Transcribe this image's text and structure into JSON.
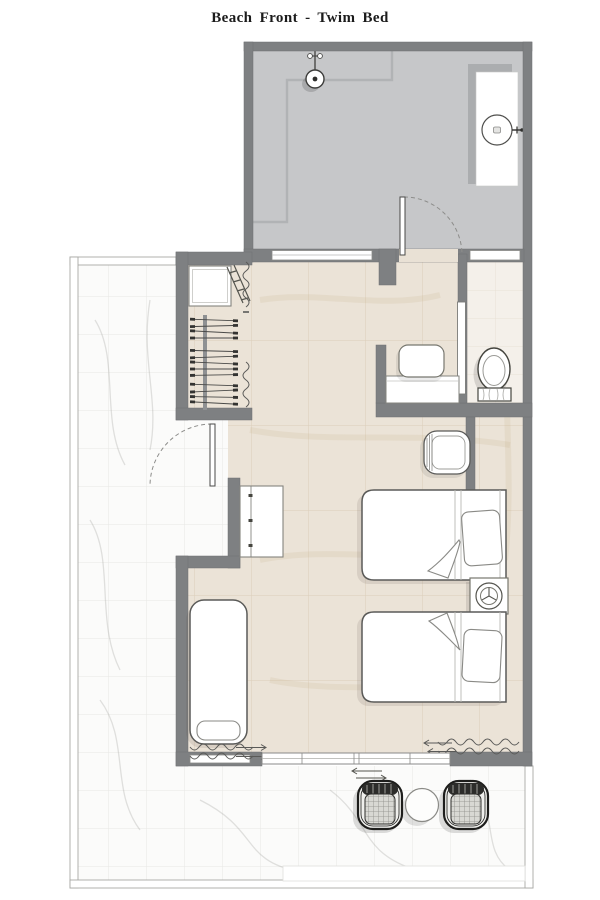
{
  "header": {
    "title": "Beach Front - Twim Bed"
  },
  "colors": {
    "wall": "#7e8082",
    "wet_area_floor": "#c6c7c9",
    "room_floor": "#ece4d8",
    "wc_floor": "#f4f0ea",
    "terrace_floor": "#fbfbfa",
    "furniture_outline": "#5a5a58",
    "background": "#ffffff"
  },
  "fixtures": [
    {
      "icon": "shower-head-icon",
      "area": "entry-bath"
    },
    {
      "icon": "vanity-sink-icon",
      "area": "entry-bath"
    },
    {
      "icon": "faucet-icon",
      "area": "entry-bath"
    },
    {
      "icon": "entry-door-icon",
      "area": "entry-bath"
    },
    {
      "icon": "toilet-icon",
      "area": "wc"
    },
    {
      "icon": "pocket-door-icon",
      "area": "wc"
    },
    {
      "icon": "hanging-rail-icon",
      "area": "wardrobe"
    },
    {
      "icon": "luggage-bench-icon",
      "area": "wardrobe"
    },
    {
      "icon": "folding-rack-icon",
      "area": "wardrobe"
    },
    {
      "icon": "curtain-icon",
      "area": "wardrobe"
    },
    {
      "icon": "desk-icon",
      "area": "dressing-nook"
    },
    {
      "icon": "stool-icon",
      "area": "dressing-nook"
    },
    {
      "icon": "armchair-icon",
      "area": "bedroom"
    },
    {
      "icon": "twin-bed-icon",
      "area": "bedroom"
    },
    {
      "icon": "twin-bed-icon",
      "area": "bedroom"
    },
    {
      "icon": "nightstand-lamp-icon",
      "area": "bedroom"
    },
    {
      "icon": "minibar-cabinet-icon",
      "area": "bedroom"
    },
    {
      "icon": "daybed-icon",
      "area": "bedroom"
    },
    {
      "icon": "curtain-icon",
      "area": "bedroom"
    },
    {
      "icon": "sliding-glass-door-icon",
      "area": "bedroom"
    },
    {
      "icon": "terrace-door-icon",
      "area": "terrace"
    },
    {
      "icon": "rattan-chair-icon",
      "area": "terrace"
    },
    {
      "icon": "rattan-chair-icon",
      "area": "terrace"
    },
    {
      "icon": "coffee-table-icon",
      "area": "terrace"
    }
  ]
}
